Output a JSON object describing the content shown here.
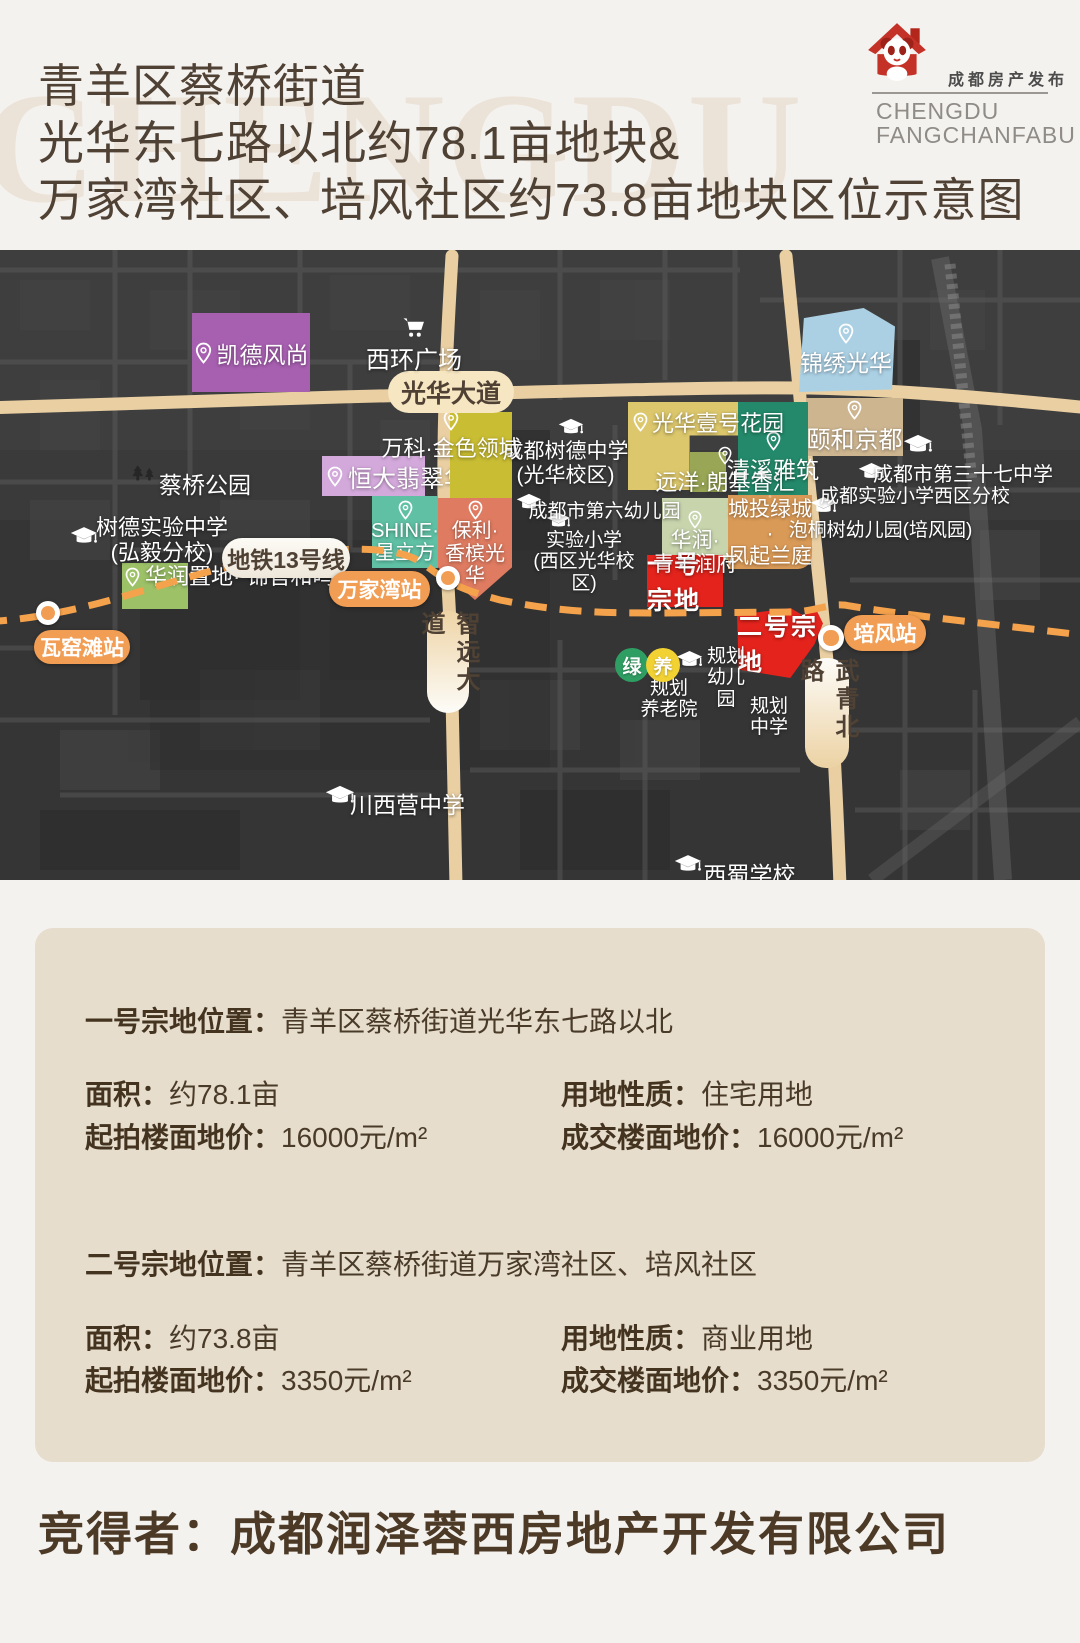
{
  "header": {
    "watermark": "CHENGDU",
    "title_lines": {
      "l1": "青羊区蔡桥街道",
      "l2": "光华东七路以北约78.1亩地块&",
      "l3": "万家湾社区、培风社区约73.8亩地块区位示意图"
    },
    "logo": {
      "cn": "成都房产发布",
      "en1": "CHENGDU",
      "en2": "FANGCHANFABU"
    }
  },
  "map": {
    "roads": {
      "guanghua": "光华大道",
      "zhiyuan": "智远大道",
      "wuqing": "武青北路"
    },
    "metro": {
      "line_label": "地铁13号线",
      "stations": {
        "wayaotan": "瓦窑滩站",
        "wanjiawan": "万家湾站",
        "peifeng": "培风站"
      }
    },
    "blocks": {
      "kaide": "凯德风尚",
      "hengda": "恒大翡翠华庭",
      "wanke": "万科·金色领域",
      "shine": "SHINE·\n星立方",
      "baoli": "保利·\n香槟光华",
      "hrjinguan": "华润置地·\n锦官和鸣",
      "jinxiu": "锦绣光华",
      "yihe": "颐和京都",
      "guanghua1": "光华壹号花园",
      "qingxi": "清溪雅筑",
      "yuanyang": "远洋·朗基香汇",
      "runfu": "华润·\n青羊润府",
      "chengtou": "城投绿城·\n凤起兰庭"
    },
    "plots": {
      "plot1": "一号宗地",
      "plot2": "二号宗地"
    },
    "schools": {
      "shude_hongyi": "树德实验中学\n(弘毅分校)",
      "shude_guanghua": "成都树德中学\n(光华校区)",
      "no37": "成都市第三十七中学",
      "shiyan_west": "成都实验小学西区分校",
      "paotong": "泡桐树幼儿园(培风园)",
      "no6": "成都市第六幼儿园",
      "shiyan_xi": "实验小学\n(西区光华校区)",
      "chuanxiying": "川西营中学",
      "xishu": "西蜀学校",
      "gh_kinder": "规划\n幼儿园"
    },
    "pois": {
      "xihuan": "西环广场",
      "caiqiao_park": "蔡桥公园",
      "gh_elder": "规划\n养老院",
      "gh_middle": "规划\n中学",
      "green_badge": "绿",
      "elder_badge": "养"
    }
  },
  "info": {
    "plot1": {
      "loc_label": "一号宗地位置：",
      "loc": "青羊区蔡桥街道光华东七路以北",
      "area_label": "面积：",
      "area": "约78.1亩",
      "use_label": "用地性质：",
      "use": "住宅用地",
      "start_label": "起拍楼面地价：",
      "start": "16000元/m²",
      "final_label": "成交楼面地价：",
      "final": "16000元/m²"
    },
    "plot2": {
      "loc_label": "二号宗地位置：",
      "loc": "青羊区蔡桥街道万家湾社区、培风社区",
      "area_label": "面积：",
      "area": "约73.8亩",
      "use_label": "用地性质：",
      "use": "商业用地",
      "start_label": "起拍楼面地价：",
      "start": "3350元/m²",
      "final_label": "成交楼面地价：",
      "final": "3350元/m²"
    }
  },
  "footer": {
    "winner_label": "竞得者：",
    "winner": "成都润泽蓉西房地产开发有限公司"
  },
  "colors": {
    "plot_red": "#e3231c",
    "metro_orange": "#f5a24c",
    "station_orange": "#f19e54",
    "road_tan": "#e9cfa2",
    "panel_bg": "#e6ddcd",
    "title_brown": "#4f4134",
    "logo_red": "#c43227"
  }
}
